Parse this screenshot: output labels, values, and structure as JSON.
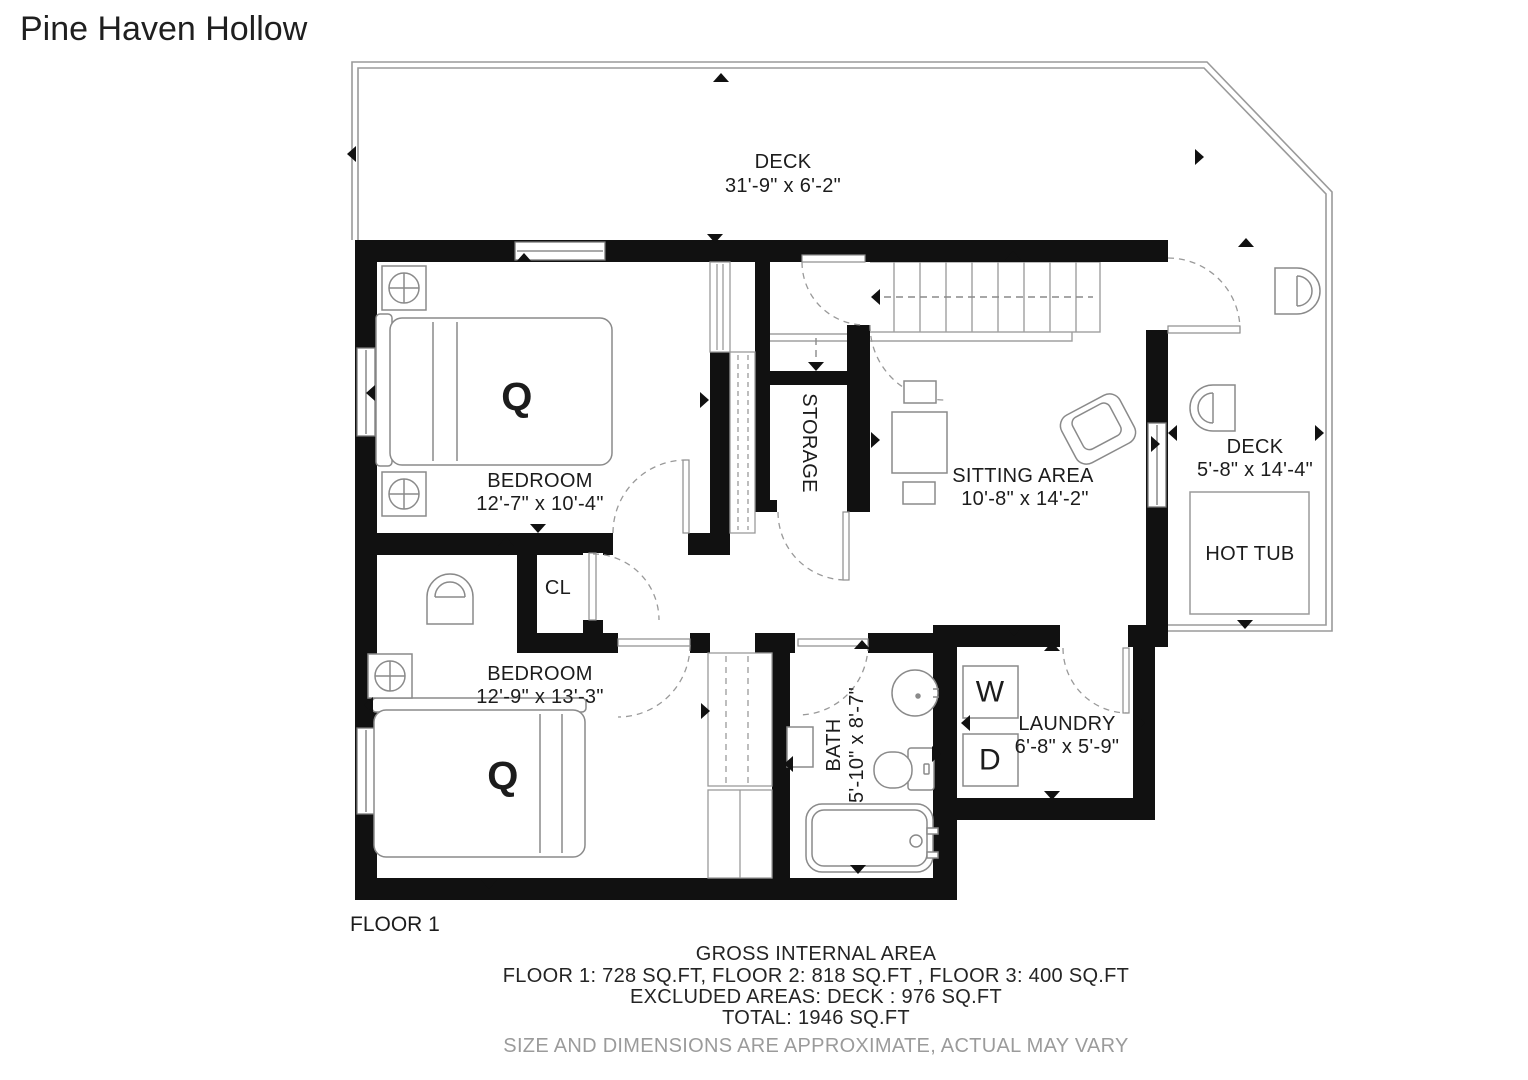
{
  "title": "Pine Haven Hollow",
  "floor": {
    "label": "FLOOR 1"
  },
  "rooms": {
    "deck_top": {
      "name": "DECK",
      "dims": "31'-9\" x 6'-2\""
    },
    "bedroom_1": {
      "name": "BEDROOM",
      "dims": "12'-7\" x 10'-4\""
    },
    "storage": {
      "name": "STORAGE"
    },
    "sitting_area": {
      "name": "SITTING AREA",
      "dims": "10'-8\" x 14'-2\""
    },
    "deck_right": {
      "name": "DECK",
      "dims": "5'-8\" x 14'-4\""
    },
    "closet": {
      "name": "CL"
    },
    "bedroom_2": {
      "name": "BEDROOM",
      "dims": "12'-9\" x 13'-3\""
    },
    "bath": {
      "name": "BATH",
      "dims": "5'-10\" x 8'-7\""
    },
    "laundry": {
      "name": "LAUNDRY",
      "dims": "6'-8\" x 5'-9\""
    }
  },
  "fixtures": {
    "hot_tub": "HOT TUB",
    "washer": "W",
    "dryer": "D",
    "bed_1": "Q",
    "bed_2": "Q"
  },
  "area_summary": {
    "heading": "GROSS INTERNAL AREA",
    "floors": "FLOOR 1: 728 SQ.FT, FLOOR 2: 818 SQ.FT , FLOOR 3: 400 SQ.FT",
    "excluded": "EXCLUDED AREAS: DECK : 976 SQ.FT",
    "total": "TOTAL: 1946 SQ.FT",
    "disclaimer": "SIZE AND DIMENSIONS ARE APPROXIMATE, ACTUAL MAY VARY"
  },
  "colors": {
    "wall": "#111111",
    "line": "#8a8a8a",
    "text": "#1c1c1c",
    "disclaimer": "#9b9b9b"
  }
}
